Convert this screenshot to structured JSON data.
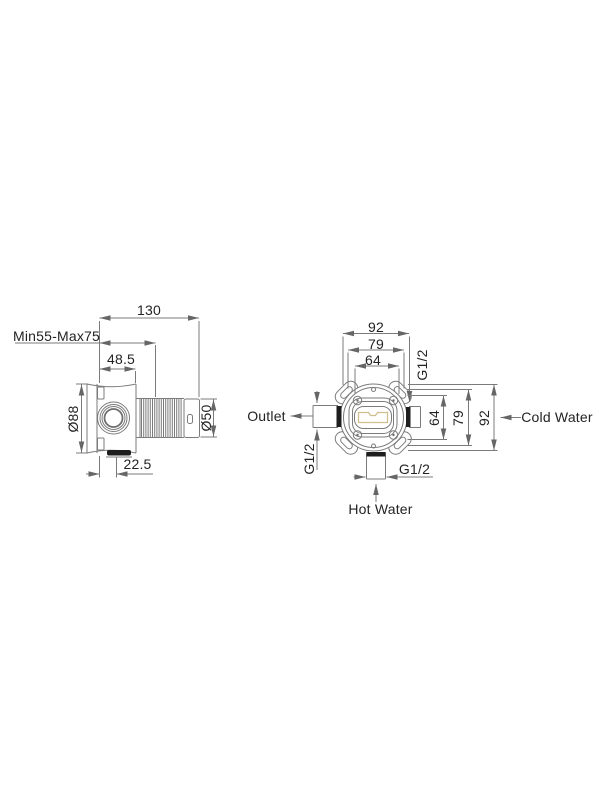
{
  "page": {
    "background": "#ffffff"
  },
  "colors": {
    "line": "#7b7b7b",
    "text": "#232323",
    "dark_fill": "#1e1e1e",
    "slot_highlight": "#cfc08d"
  },
  "side_view": {
    "dims": {
      "overall_length": "130",
      "install_depth_range": "Min55-Max75",
      "body_depth": "48.5",
      "body_diameter": "Ø88",
      "sleeve_diameter": "Ø50",
      "outlet_offset": "22.5"
    }
  },
  "front_view": {
    "dims": {
      "width_outer": "92",
      "width_middle": "79",
      "width_inner": "64",
      "height_inner": "64",
      "height_middle": "79",
      "height_outer": "92",
      "thread_cold": "G1/2",
      "thread_outlet": "G1/2",
      "thread_hot": "G1/2"
    },
    "labels": {
      "outlet": "Outlet",
      "cold_water": "Cold Water",
      "hot_water": "Hot Water"
    }
  }
}
